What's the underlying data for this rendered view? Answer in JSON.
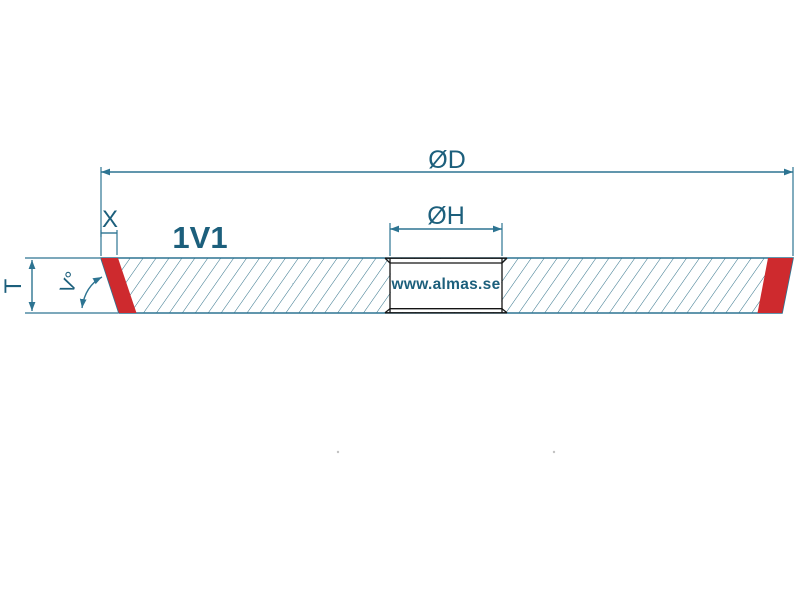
{
  "drawing": {
    "profile_label": "1V1",
    "watermark": "www.almas.se",
    "labels": {
      "outer_diameter": "ØD",
      "hole_diameter": "ØH",
      "thickness": "T",
      "rim_width": "X",
      "rim_angle": "V°"
    },
    "colors": {
      "dimension_line_teal": "#2d7492",
      "label_text_teal": "#1c5f7c",
      "abrasive_rim_red": "#ce2a2e",
      "hole_outline_black": "#141414",
      "hatch_line_teal": "#2e7088",
      "background": "#ffffff"
    }
  }
}
